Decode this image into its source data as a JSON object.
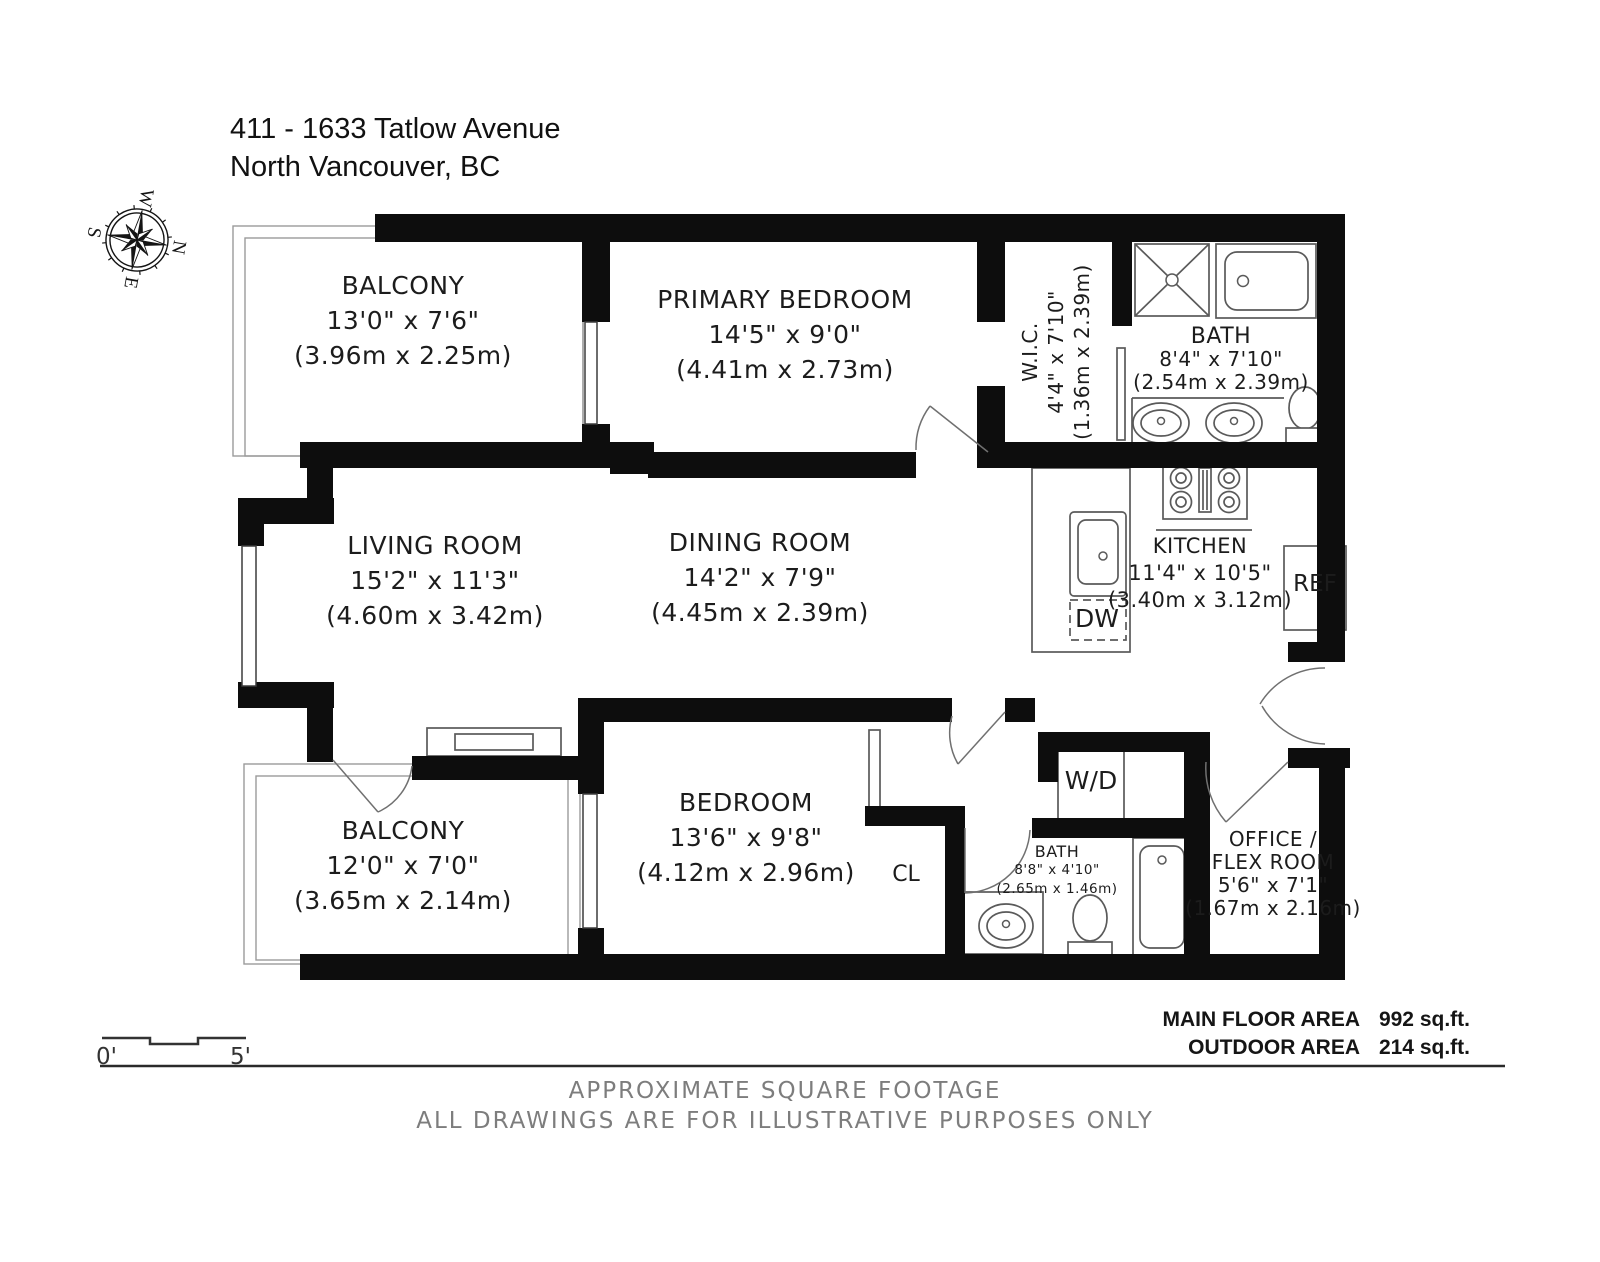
{
  "title": {
    "line1": "411 - 1633 Tatlow Avenue",
    "line2": "North Vancouver, BC"
  },
  "compass": {
    "n": "N",
    "e": "E",
    "s": "S",
    "w": "W"
  },
  "rooms": {
    "balcony1": {
      "name": "BALCONY",
      "imperial": "13'0\" x 7'6\"",
      "metric": "(3.96m x 2.25m)"
    },
    "primary_bedroom": {
      "name": "PRIMARY BEDROOM",
      "imperial": "14'5\" x 9'0\"",
      "metric": "(4.41m x 2.73m)"
    },
    "wic": {
      "name": "W.I.C.",
      "imperial": "4'4\" x 7'10\"",
      "metric": "(1.36m x 2.39m)"
    },
    "bath1": {
      "name": "BATH",
      "imperial": "8'4\" x 7'10\"",
      "metric": "(2.54m x 2.39m)"
    },
    "living": {
      "name": "LIVING ROOM",
      "imperial": "15'2\" x 11'3\"",
      "metric": "(4.60m x 3.42m)"
    },
    "dining": {
      "name": "DINING ROOM",
      "imperial": "14'2\" x 7'9\"",
      "metric": "(4.45m x 2.39m)"
    },
    "kitchen": {
      "name": "KITCHEN",
      "imperial": "11'4\" x 10'5\"",
      "metric": "(3.40m x 3.12m)"
    },
    "balcony2": {
      "name": "BALCONY",
      "imperial": "12'0\" x 7'0\"",
      "metric": "(3.65m x 2.14m)"
    },
    "bedroom": {
      "name": "BEDROOM",
      "imperial": "13'6\" x 9'8\"",
      "metric": "(4.12m x 2.96m)"
    },
    "bath2": {
      "name": "BATH",
      "imperial": "8'8\" x 4'10\"",
      "metric": "(2.65m x 1.46m)"
    },
    "office": {
      "name1": "OFFICE /",
      "name2": "FLEX ROOM",
      "imperial": "5'6\" x 7'1\"",
      "metric": "(1.67m x 2.16m)"
    }
  },
  "appliances": {
    "ref": "REF",
    "dw": "DW",
    "wd": "W/D",
    "cl": "CL"
  },
  "scale": {
    "start": "0'",
    "end": "5'"
  },
  "areas": [
    {
      "label": "MAIN FLOOR AREA",
      "value": "992 sq.ft."
    },
    {
      "label": "OUTDOOR AREA",
      "value": "214 sq.ft."
    }
  ],
  "footer": {
    "line1": "APPROXIMATE SQUARE FOOTAGE",
    "line2": "ALL DRAWINGS ARE FOR ILLUSTRATIVE PURPOSES ONLY"
  }
}
